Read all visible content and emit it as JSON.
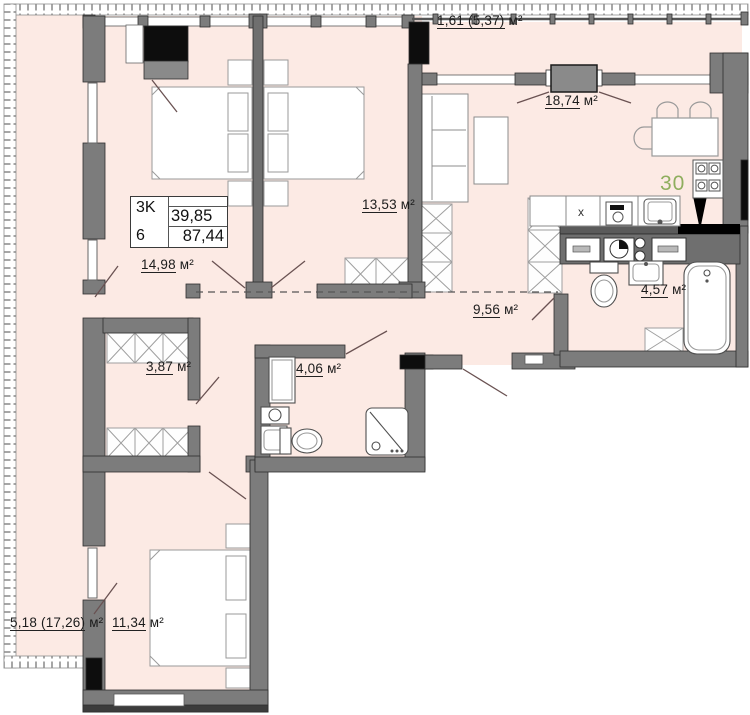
{
  "title": "Apartment floor plan",
  "apartment_number": "30",
  "info_box": {
    "type_label": "3K",
    "entrance_label": "6",
    "living_area": "39,85",
    "total_area": "87,44"
  },
  "labels": {
    "balcony": {
      "value": "1,61 (5,37)",
      "unit": "м²"
    },
    "kitchen_living": {
      "value": "18,74",
      "unit": "м²"
    },
    "bedroom_2": {
      "value": "13,53",
      "unit": "м²"
    },
    "bedroom_1": {
      "value": "14,98",
      "unit": "м²"
    },
    "corridor": {
      "value": "9,56",
      "unit": "м²"
    },
    "bathroom": {
      "value": "4,57",
      "unit": "м²"
    },
    "closet": {
      "value": "3,87",
      "unit": "м²"
    },
    "shower_room": {
      "value": "4,06",
      "unit": "м²"
    },
    "bedroom_3": {
      "value": "11,34",
      "unit": "м²"
    },
    "terrace": {
      "value": "5,18 (17,26)",
      "unit": "м²"
    }
  },
  "counter_mark": "x",
  "colors": {
    "floor": "#fceae4",
    "wall": "#7c7c7c",
    "black": "#0d0d0d",
    "accent_green": "#8fae5e"
  }
}
